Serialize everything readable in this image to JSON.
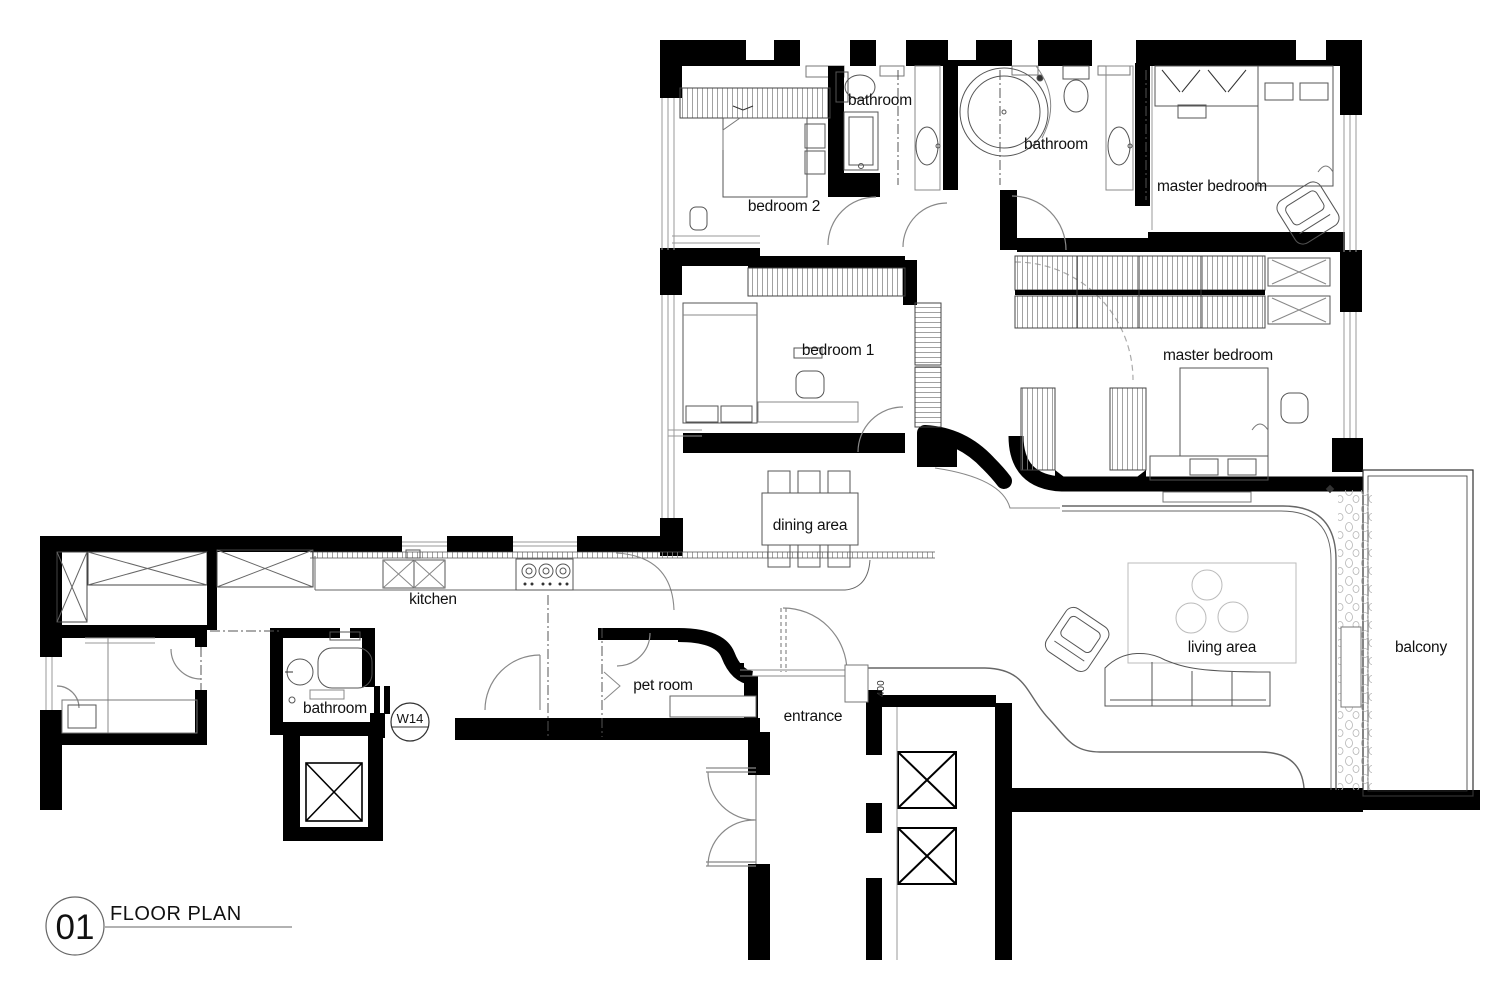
{
  "drawing": {
    "number": "01",
    "title": "FLOOR PLAN"
  },
  "labels": {
    "bedroom2": "bedroom 2",
    "bedroom1": "bedroom 1",
    "bathroom_top": "bathroom",
    "bathroom_master": "bathroom",
    "bathroom_service": "bathroom",
    "master_bedroom_top": "master bedroom",
    "master_bedroom_main": "master bedroom",
    "dining": "dining area",
    "kitchen": "kitchen",
    "living": "living area",
    "balcony": "balcony",
    "pet_room": "pet room",
    "entrance": "entrance"
  },
  "annotations": {
    "window_tag": "W14",
    "door_width": "400"
  },
  "colors": {
    "wall": "#000000",
    "background": "#ffffff",
    "furniture_line": "#555555",
    "light_line": "#999999",
    "hatch": "#8a8a8a"
  }
}
